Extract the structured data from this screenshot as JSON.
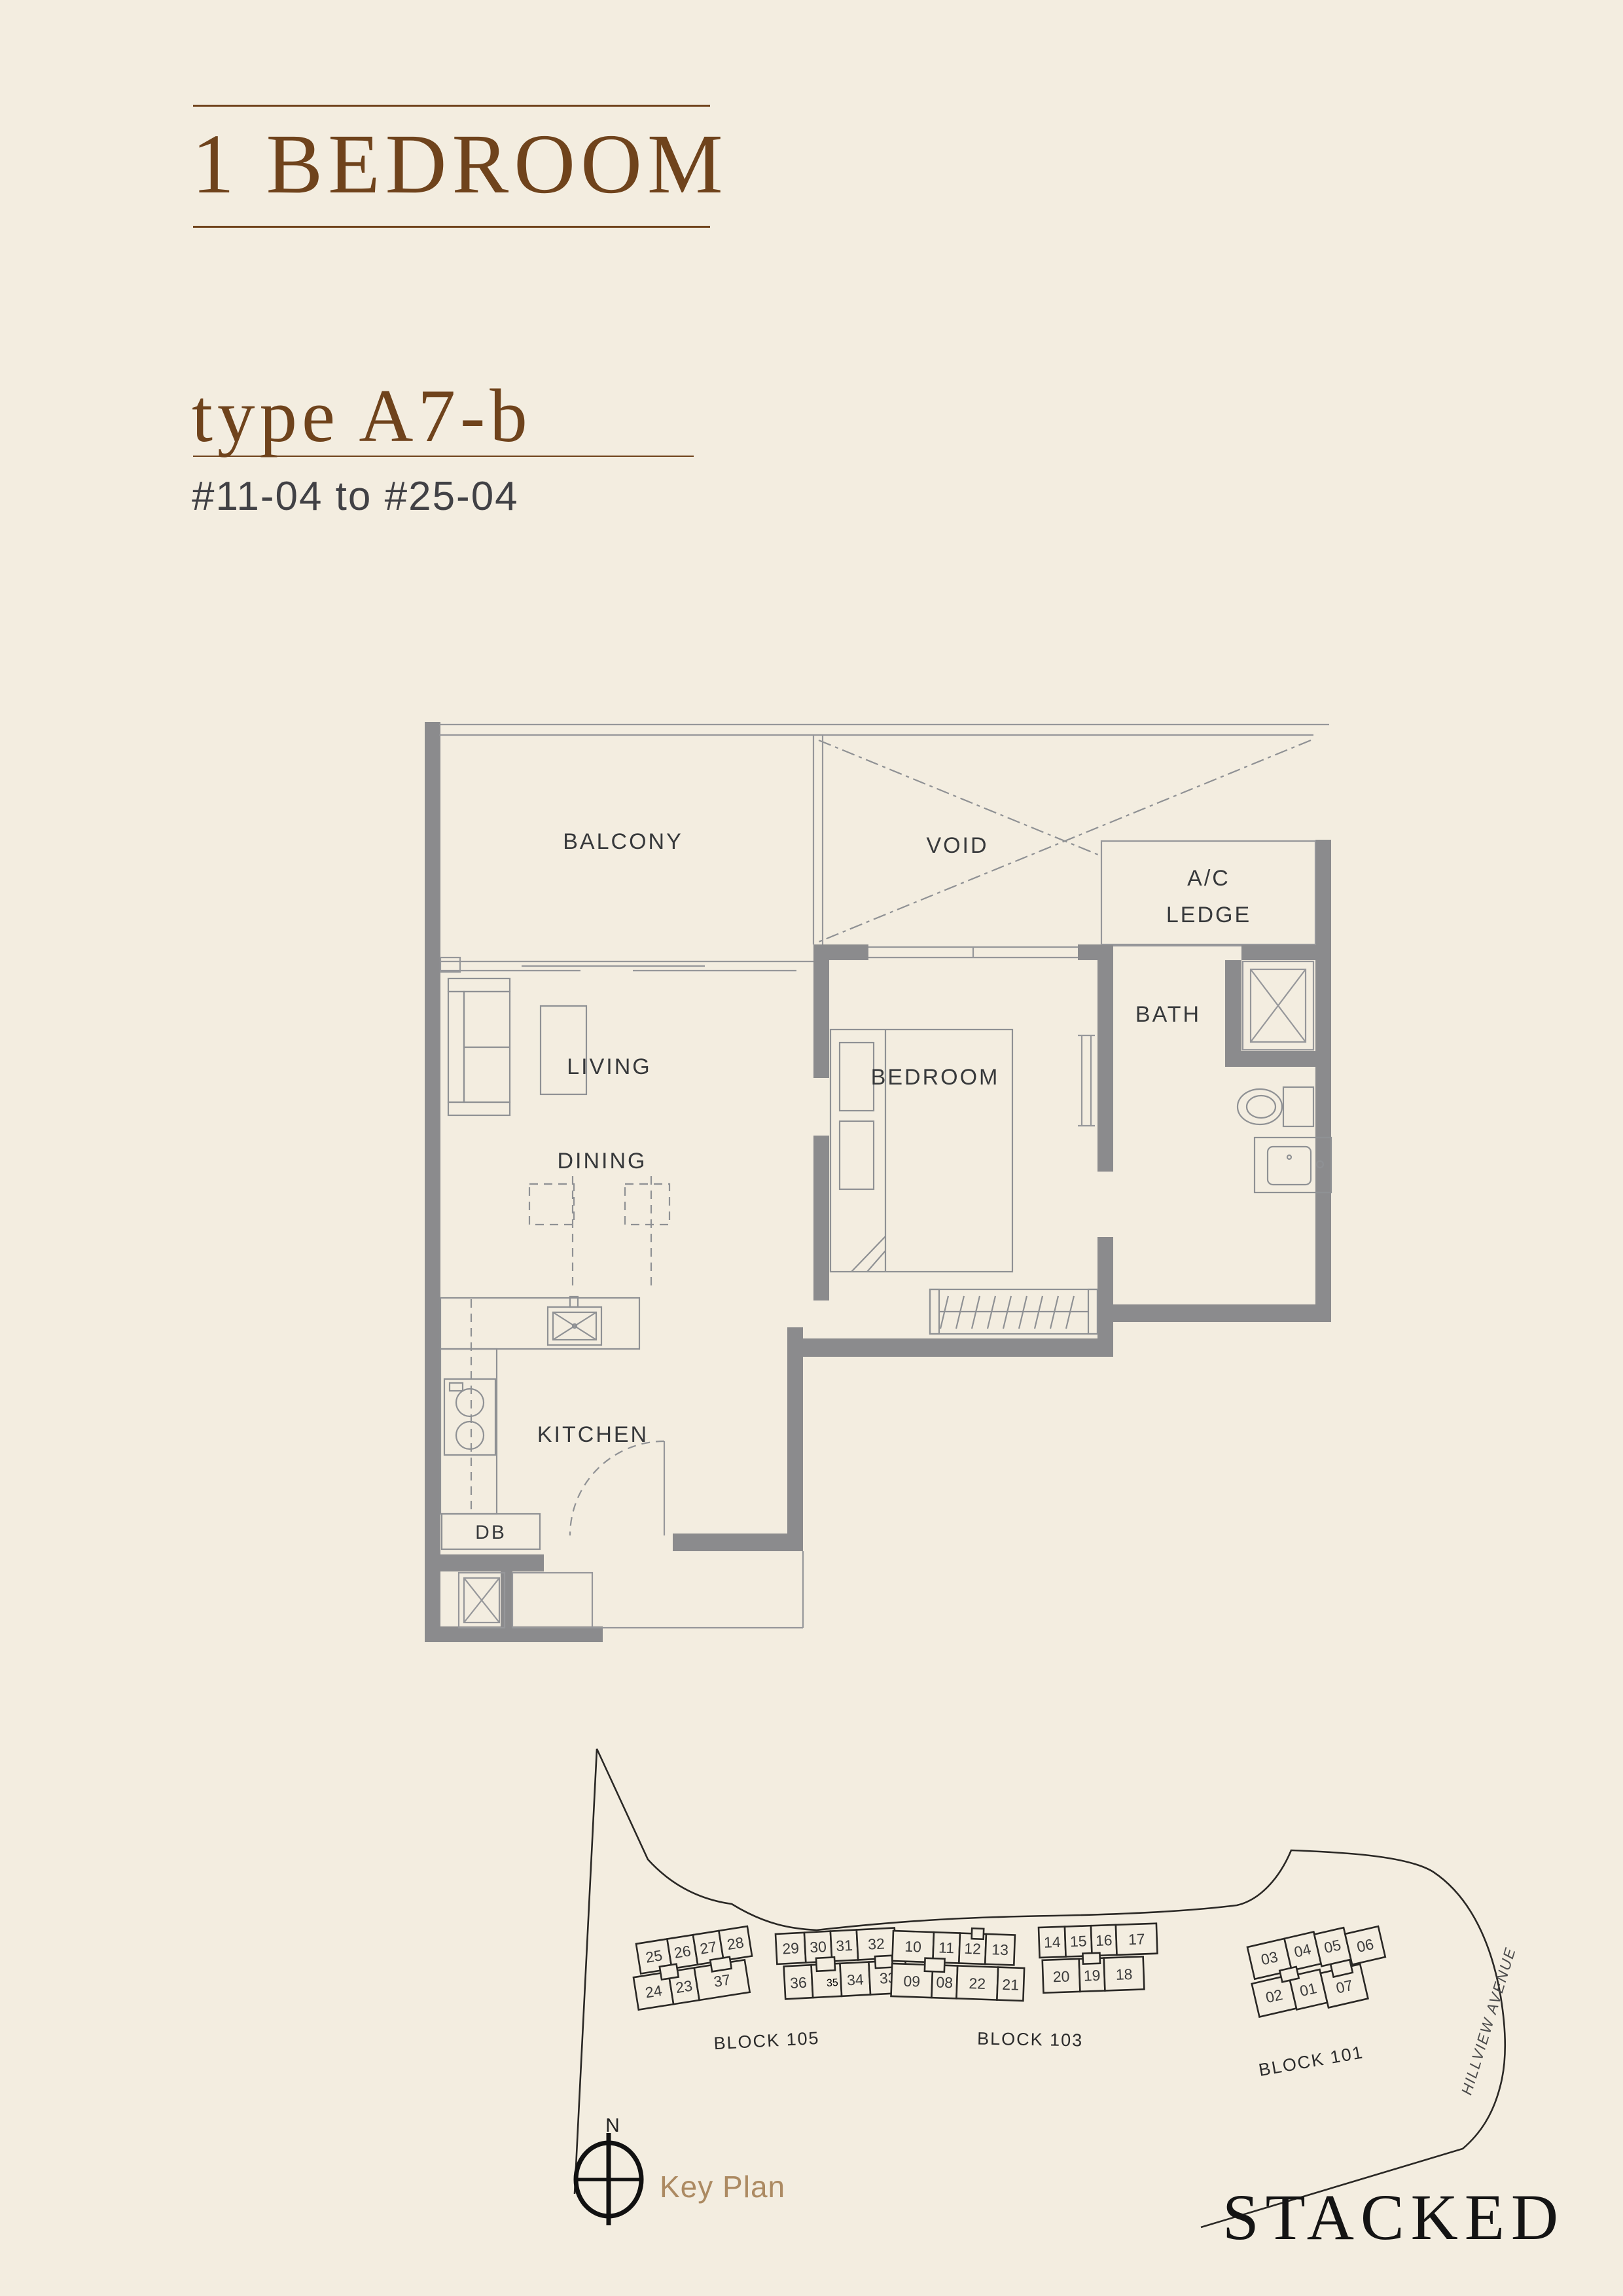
{
  "page": {
    "background": "#f3ede0",
    "accent_color": "#6f431c"
  },
  "header": {
    "title": "1 BEDROOM",
    "unit_type": "type A7-b",
    "unit_range": "#11-04 to #25-04"
  },
  "floorplan": {
    "wall_color": "#8b8b8d",
    "line_color": "#96979a",
    "label_color": "#37393b",
    "rooms": {
      "balcony": "BALCONY",
      "void": "VOID",
      "ac_line1": "A/C",
      "ac_line2": "LEDGE",
      "living": "LIVING",
      "dining": "DINING",
      "bedroom": "BEDROOM",
      "bath": "BATH",
      "kitchen": "KITCHEN",
      "db": "DB"
    }
  },
  "keyplan": {
    "caption": "Key Plan",
    "north_label": "N",
    "street": "HILLVIEW AVENUE",
    "highlighted_unit": "04",
    "highlight_color": "#b78a5f",
    "blocks": [
      {
        "name": "BLOCK 105",
        "top": [
          "25",
          "26",
          "27",
          "28",
          "29",
          "30",
          "31",
          "32"
        ],
        "bottom": [
          "24",
          "23",
          "37",
          "36",
          "35",
          "34",
          "33"
        ]
      },
      {
        "name": "BLOCK 103",
        "top": [
          "10",
          "11",
          "12",
          "13",
          "14",
          "15",
          "16",
          "17"
        ],
        "bottom": [
          "09",
          "08",
          "22",
          "21",
          "20",
          "19",
          "18"
        ]
      },
      {
        "name": "BLOCK 101",
        "top": [
          "03",
          "04",
          "05",
          "06"
        ],
        "bottom": [
          "02",
          "01",
          "07"
        ]
      }
    ]
  },
  "branding": {
    "logo": "STACKED"
  }
}
